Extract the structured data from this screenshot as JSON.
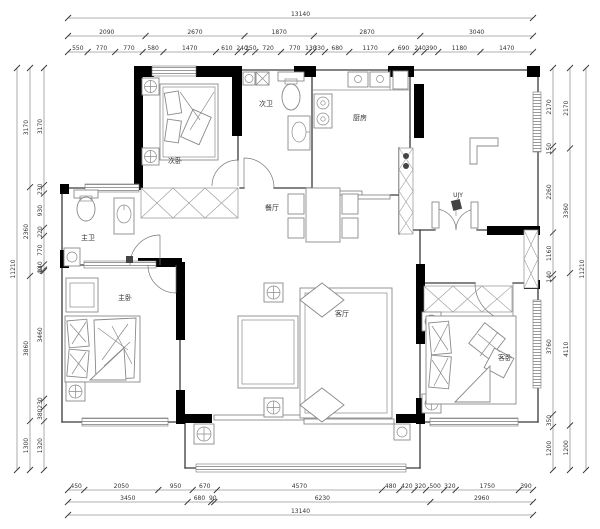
{
  "plan": {
    "rooms": {
      "secondary_bedroom": "次卧",
      "master_bath": "主卫",
      "master_bedroom": "主卧",
      "secondary_bath": "次卫",
      "kitchen": "厨房",
      "dining": "餐厅",
      "living": "客厅",
      "guest_bedroom": "客卧",
      "entry_note": "UJY"
    },
    "colors": {
      "wall": "#000000",
      "thin_line": "#3a3a3a",
      "furniture": "#8a8a8a",
      "window": "#777777",
      "dimension": "#333333",
      "background": "#ffffff"
    }
  },
  "dimensions": {
    "top": {
      "total": [
        "13140"
      ],
      "row2": [
        "2090",
        "2670",
        "1870",
        "2870",
        "3040"
      ],
      "row3": [
        "550",
        "770",
        "770",
        "580",
        "1470",
        "610",
        "240",
        "250",
        "720",
        "770",
        "130",
        "330",
        "680",
        "1170",
        "690",
        "240",
        "390",
        "1180",
        "1470"
      ]
    },
    "bottom": {
      "row1": [
        "450",
        "2050",
        "950",
        "670",
        "4570",
        "480",
        "420",
        "320",
        "500",
        "320",
        "1750",
        "390"
      ],
      "row2": [
        "3450",
        "680",
        "90",
        "6230",
        "2960"
      ],
      "total": [
        "13140"
      ]
    },
    "left": {
      "outer": [
        "11210"
      ],
      "mid": [
        "3170",
        "2360",
        "3860",
        "1300"
      ],
      "inner": [
        "3170",
        "230",
        "930",
        "220",
        "770",
        "140",
        "40",
        "3460",
        "230",
        "380",
        "1320"
      ]
    },
    "right": {
      "outer": [
        "11210"
      ],
      "mid": [
        "2170",
        "3360",
        "4110",
        "1200"
      ],
      "inner": [
        "2170",
        "150",
        "2260",
        "1160",
        "140",
        "3760",
        "350",
        "1200"
      ]
    }
  }
}
